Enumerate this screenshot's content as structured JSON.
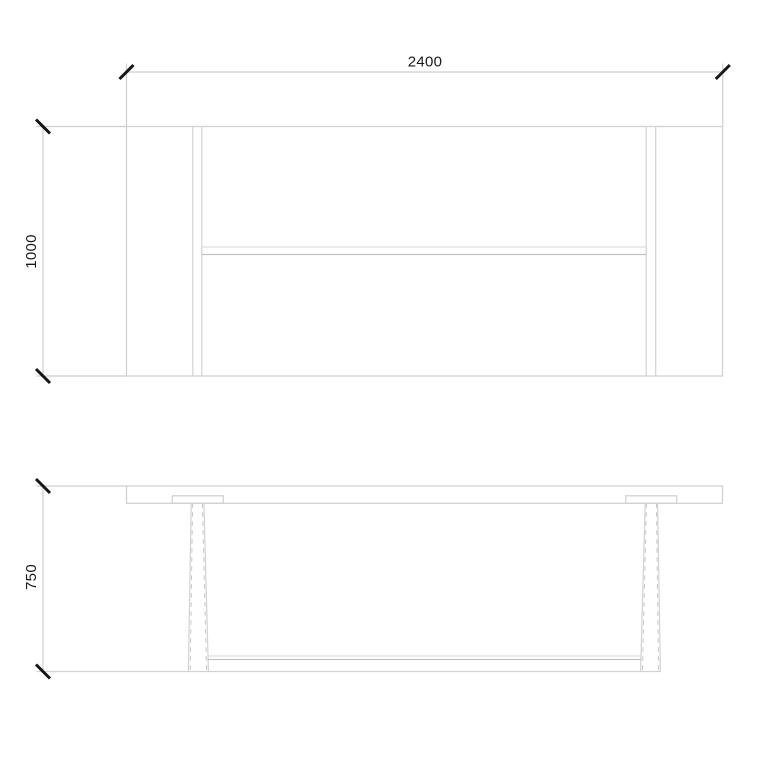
{
  "canvas": {
    "width": 768,
    "height": 768
  },
  "colors": {
    "background": "#ffffff",
    "object_line": "#d2d2d2",
    "object_line_light": "#dedede",
    "object_line_dark": "#c2c2c2",
    "hidden_line": "#c6c6c6",
    "dimension_line": "#cfcfcf",
    "tick": "#161616",
    "text": "#1a1a1a"
  },
  "dimensions": {
    "width": {
      "value": "2400"
    },
    "depth": {
      "value": "1000"
    },
    "height": {
      "value": "750"
    }
  }
}
